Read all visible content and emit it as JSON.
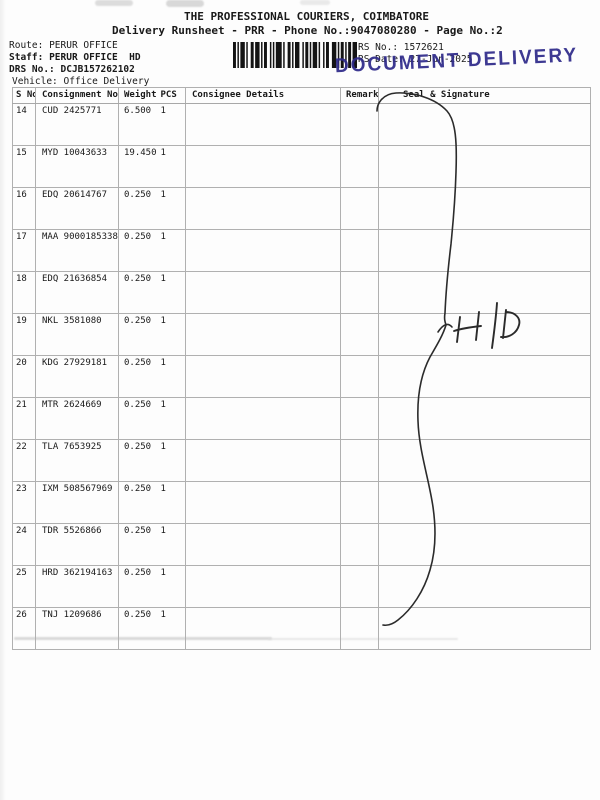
{
  "page": {
    "title": "THE PROFESSIONAL COURIERS, COIMBATORE",
    "subtitle": "Delivery Runsheet - PRR - Phone No.:9047080280 - Page No.:2"
  },
  "info": {
    "route_label": "Route:",
    "route": "PERUR OFFICE",
    "staff_label": "Staff:",
    "staff": "PERUR OFFICE  HD",
    "drs_label": "DRS No.:",
    "drs_no": "DCJB157262102",
    "vehicle_label": "Vehicle:",
    "vehicle": "Office Delivery",
    "rs_no_label": "RS No.:",
    "rs_no": "1572621",
    "rs_date_label": "RS Date:",
    "rs_date": "27-Jun-2025"
  },
  "stamp": {
    "text": "DOCUMENT DELIVERY",
    "color": "#2f2b8a"
  },
  "handwriting": {
    "seal_annotation": "H|D"
  },
  "table": {
    "headers": [
      "S No",
      "Consignment No",
      "Weight",
      "PCS",
      "Consignee Details",
      "Remarks",
      "Seal & Signature"
    ],
    "rows": [
      {
        "s_no": "14",
        "consignment_no": "CUD 2425771",
        "weight": "6.500",
        "pcs": "1",
        "consignee_details": "",
        "remarks": "",
        "seal_signature": ""
      },
      {
        "s_no": "15",
        "consignment_no": "MYD 10043633",
        "weight": "19.450",
        "pcs": "1",
        "consignee_details": "",
        "remarks": "",
        "seal_signature": ""
      },
      {
        "s_no": "16",
        "consignment_no": "EDQ 20614767",
        "weight": "0.250",
        "pcs": "1",
        "consignee_details": "",
        "remarks": "",
        "seal_signature": ""
      },
      {
        "s_no": "17",
        "consignment_no": "MAA 9000185338",
        "weight": "0.250",
        "pcs": "1",
        "consignee_details": "",
        "remarks": "",
        "seal_signature": ""
      },
      {
        "s_no": "18",
        "consignment_no": "EDQ 21636854",
        "weight": "0.250",
        "pcs": "1",
        "consignee_details": "",
        "remarks": "",
        "seal_signature": ""
      },
      {
        "s_no": "19",
        "consignment_no": "NKL 3581080",
        "weight": "0.250",
        "pcs": "1",
        "consignee_details": "",
        "remarks": "",
        "seal_signature": ""
      },
      {
        "s_no": "20",
        "consignment_no": "KDG 27929181",
        "weight": "0.250",
        "pcs": "1",
        "consignee_details": "",
        "remarks": "",
        "seal_signature": ""
      },
      {
        "s_no": "21",
        "consignment_no": "MTR 2624669",
        "weight": "0.250",
        "pcs": "1",
        "consignee_details": "",
        "remarks": "",
        "seal_signature": ""
      },
      {
        "s_no": "22",
        "consignment_no": "TLA 7653925",
        "weight": "0.250",
        "pcs": "1",
        "consignee_details": "",
        "remarks": "",
        "seal_signature": ""
      },
      {
        "s_no": "23",
        "consignment_no": "IXM 508567969",
        "weight": "0.250",
        "pcs": "1",
        "consignee_details": "",
        "remarks": "",
        "seal_signature": ""
      },
      {
        "s_no": "24",
        "consignment_no": "TDR 5526866",
        "weight": "0.250",
        "pcs": "1",
        "consignee_details": "",
        "remarks": "",
        "seal_signature": ""
      },
      {
        "s_no": "25",
        "consignment_no": "HRD 362194163",
        "weight": "0.250",
        "pcs": "1",
        "consignee_details": "",
        "remarks": "",
        "seal_signature": ""
      },
      {
        "s_no": "26",
        "consignment_no": "TNJ 1209686",
        "weight": "0.250",
        "pcs": "1",
        "consignee_details": "",
        "remarks": "",
        "seal_signature": ""
      }
    ]
  }
}
